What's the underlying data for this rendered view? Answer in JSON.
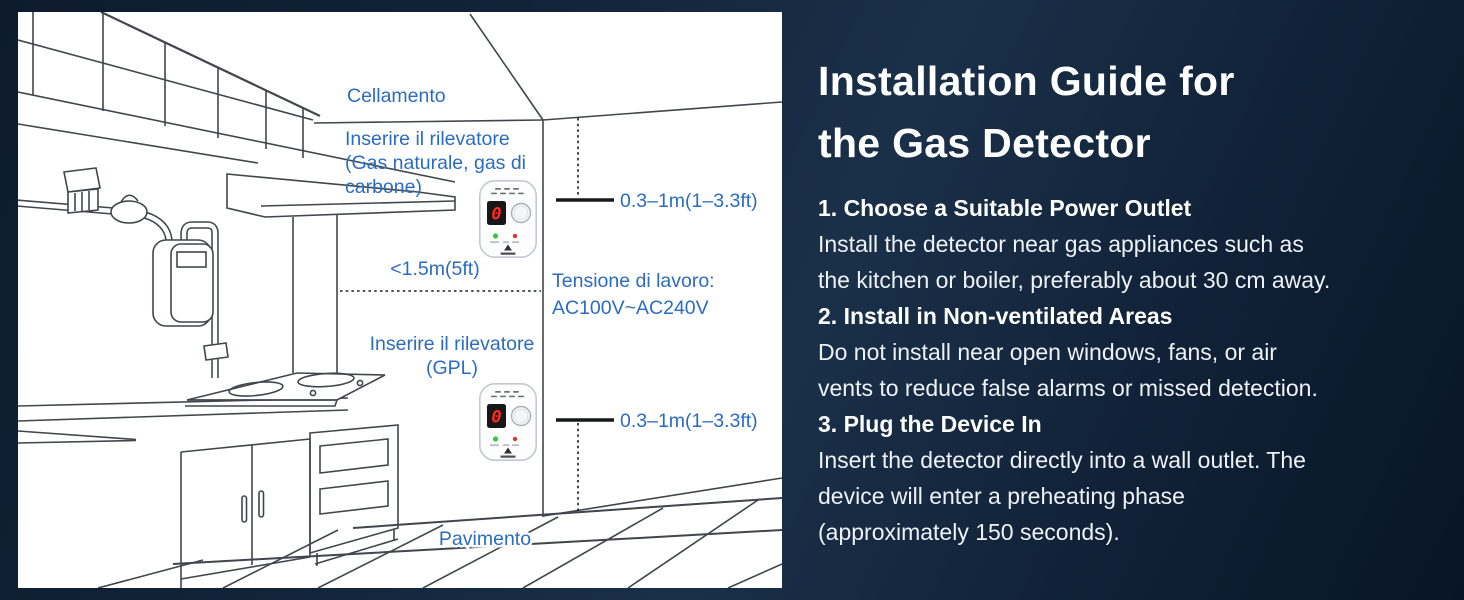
{
  "colors": {
    "background_navy": "#122338",
    "panel_bg": "#ffffff",
    "line_art": "#41464d",
    "label_blue": "#2b6cc2",
    "title_white": "#ffffff",
    "led_green": "#35c93f",
    "led_red": "#d43a2f",
    "digit_red": "#ff2d1e"
  },
  "diagram": {
    "labels": {
      "ceiling": "Cellamento",
      "detector1_l1": "Inserire il rilevatore",
      "detector1_l2": "(Gas naturale, gas di",
      "detector1_l3": "carbone)",
      "range_top": "0.3–1m(1–3.3ft)",
      "distance": "<1.5m(5ft)",
      "voltage_l1": "Tensione di lavoro:",
      "voltage_l2": "AC100V~AC240V",
      "detector2_l1": "Inserire il rilevatore",
      "detector2_l2": "(GPL)",
      "range_bottom": "0.3–1m(1–3.3ft)",
      "floor": "Pavimento"
    },
    "device": {
      "display_value": "0"
    }
  },
  "guide": {
    "title_lines": [
      "Installation Guide for",
      "the Gas Detector"
    ],
    "steps": [
      {
        "heading": "1. Choose a Suitable Power Outlet",
        "lines": [
          "Install the detector near gas appliances such as",
          "the kitchen or boiler, preferably about 30 cm away."
        ]
      },
      {
        "heading": "2. Install in Non-ventilated Areas",
        "lines": [
          "Do not install near open windows, fans, or air",
          "vents to reduce false alarms or missed detection."
        ]
      },
      {
        "heading": "3. Plug the Device In",
        "lines": [
          "Insert the detector directly into a wall outlet. The",
          "device will enter a preheating phase",
          "(approximately 150 seconds)."
        ]
      }
    ]
  }
}
